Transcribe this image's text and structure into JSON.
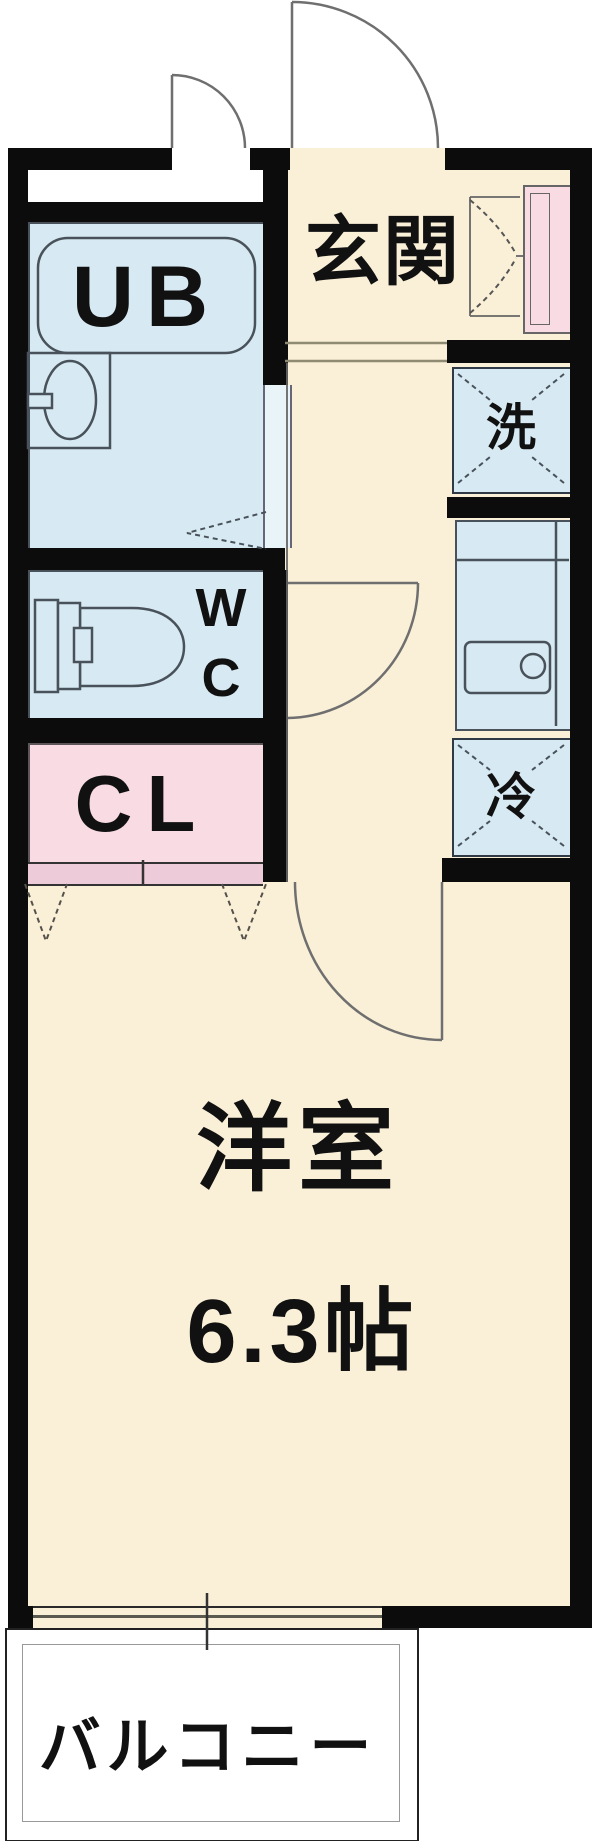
{
  "labels": {
    "unit_bath": "UB",
    "entrance": "玄関",
    "washer": "洗",
    "toilet_line1": "W",
    "toilet_line2": "C",
    "fridge": "冷",
    "closet": "CL",
    "room_name": "洋室",
    "room_size": "6.3帖",
    "balcony": "バルコニー"
  },
  "colors": {
    "wall": "#0c0c0c",
    "cream": "#faf0d8",
    "room_blue": "#d7eaf3",
    "door_strip": "#e9f4f9",
    "pink": "#f8dbe3",
    "closet_door_band": "#eecbd8",
    "fixture_line": "#49525a",
    "door_line": "#6f6f6f",
    "step_line": "#8f8a72",
    "inner_fence_line": "#999999",
    "text": "#111111"
  }
}
